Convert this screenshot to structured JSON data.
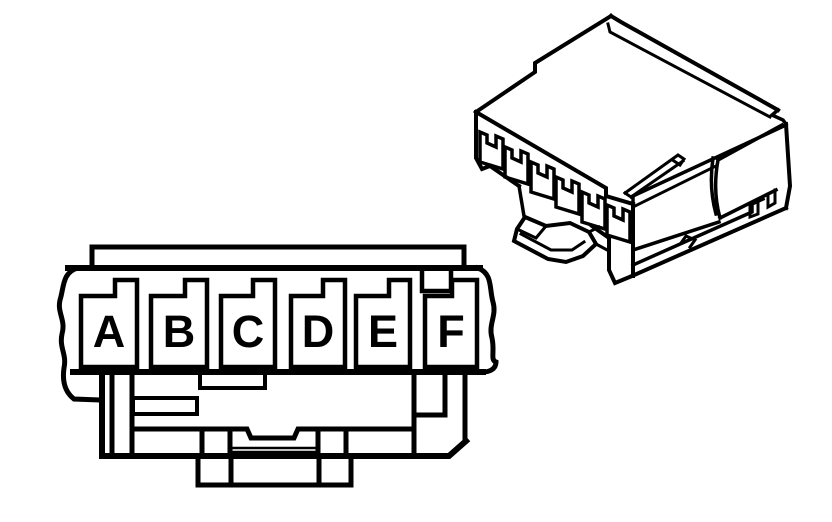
{
  "figure": {
    "colors": {
      "line": "#000000",
      "background": "#ffffff"
    },
    "front_view": {
      "cavities": [
        {
          "label": "A"
        },
        {
          "label": "B"
        },
        {
          "label": "C"
        },
        {
          "label": "D"
        },
        {
          "label": "E"
        },
        {
          "label": "F"
        }
      ]
    },
    "isometric_view": {
      "cavity_count": "6"
    }
  }
}
